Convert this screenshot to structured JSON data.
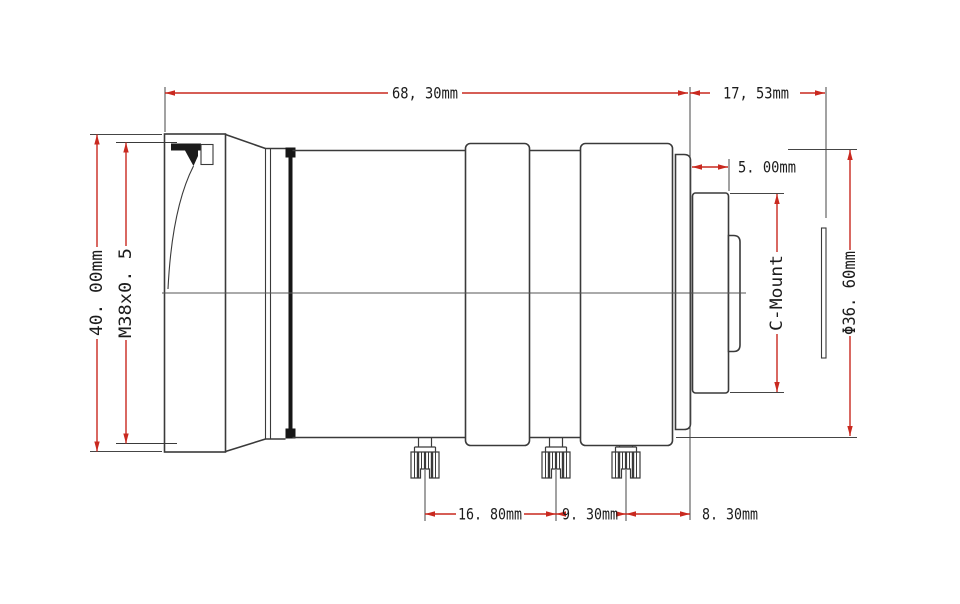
{
  "drawing": {
    "type": "lens mechanical drawing, side elevation with dimensions",
    "subject": "C-Mount machine vision lens",
    "colors": {
      "outline": "#3a3a3a",
      "dimension_red": "#c9291f",
      "text": "#1c1c1c",
      "background": "#ffffff"
    },
    "labels": {
      "overall_length": "68, 30mm",
      "flange_focal_distance": "17, 53mm",
      "mount_length": "5. 00mm",
      "front_diameter": "40. 00mm",
      "front_thread": "M38x0. 5",
      "mount_type": "C-Mount",
      "rear_diameter": "Φ36. 60mm",
      "screw_spacing_front": "16. 80mm",
      "screw_spacing_mid": "9. 30mm",
      "screw_spacing_rear": "8. 30mm"
    }
  }
}
